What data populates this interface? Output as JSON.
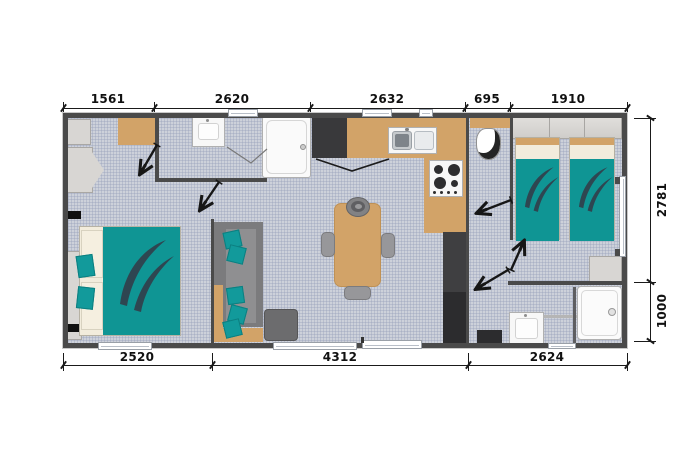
{
  "palette": {
    "wall": "#4a4a4a",
    "floor_tile": "#cdd1da",
    "wood": "#d2a368",
    "teal_fabric": "#0f9594",
    "swoosh": "#2e4651",
    "cream": "#f2ecdc",
    "light_cabinet": "#d8d6d3",
    "charcoal": "#39393b",
    "sofa_gray": "#7b7b7d",
    "fixture_white": "#f7f7f7",
    "dimension_text": "#111111"
  },
  "dimensions": {
    "top": [
      "1561",
      "2620",
      "2632",
      "695",
      "1910"
    ],
    "right": [
      "2781",
      "1000"
    ],
    "bottom": [
      "2520",
      "4312",
      "2624"
    ]
  }
}
